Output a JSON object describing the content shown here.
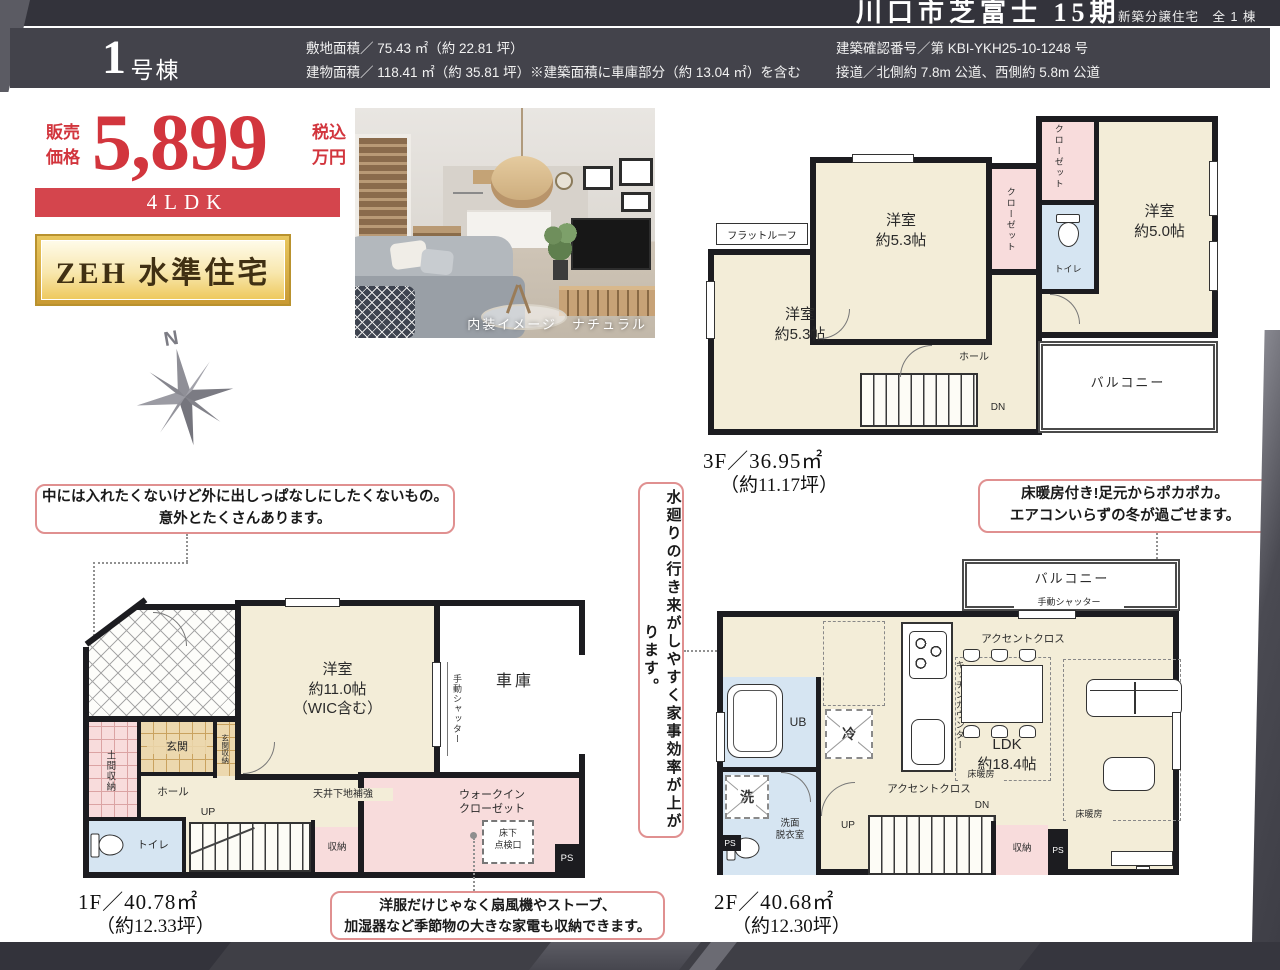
{
  "top_bar": {
    "title": "川口市芝富士 15期",
    "subtitle": "新築分譲住宅　全 1 棟"
  },
  "header": {
    "unit_number": "1",
    "unit_suffix": "号棟",
    "site_area": "敷地面積／ 75.43 ㎡（約 22.81 坪）",
    "building_area": "建物面積／ 118.41 ㎡（約 35.81 坪）※建築面積に車庫部分（約 13.04 ㎡）を含む",
    "confirmation_number": "建築確認番号／第 KBI-YKH25-10-1248 号",
    "road_access": "接道／北側約 7.8m 公道、西側約 5.8m 公道"
  },
  "price": {
    "label": "販売\n価格",
    "amount": "5,899",
    "tax_note": "税込\n万円",
    "floor_plan_type": "4LDK"
  },
  "zeh_badge": "ZEH 水準住宅",
  "compass_north": "N",
  "photo_caption": "内装イメージ　ナチュラル",
  "plan_3f": {
    "floor_area": "3F／36.95㎡",
    "floor_area_tsubo": "（約11.17坪）",
    "flat_roof": "フラットルーフ",
    "bedroom_53": "洋室\n約5.3帖",
    "bedroom_50": "洋室\n約5.0帖",
    "closet": "クローゼット",
    "toilet": "トイレ",
    "hall": "ホール",
    "down": "DN",
    "balcony": "バルコニー"
  },
  "plan_1f": {
    "floor_area": "1F／40.78㎡",
    "floor_area_tsubo": "（約12.33坪）",
    "doma_storage": "土間収納",
    "entrance": "玄関",
    "entrance_storage": "玄関収納",
    "hall": "ホール",
    "up": "UP",
    "toilet": "トイレ",
    "storage": "収納",
    "bedroom_110": "洋室\n約11.0帖\n（WIC含む）",
    "manual_shutter": "手動シャッター",
    "garage": "車庫",
    "walk_in_closet": "ウォークイン\nクローゼット",
    "ceiling_reinforce": "天井下地補強",
    "floor_hatch": "床下\n点検口",
    "ps": "PS"
  },
  "plan_2f": {
    "floor_area": "2F／40.68㎡",
    "floor_area_tsubo": "（約12.30坪）",
    "balcony": "バルコニー",
    "manual_shutter": "手動シャッター",
    "accent_cloth": "アクセントクロス",
    "kitchen_counter": "キッチンカウンター",
    "ldk": "LDK\n約18.4帖",
    "floor_heating": "床暖房",
    "ub": "UB",
    "fridge": "冷",
    "washer": "洗",
    "washroom": "洗面\n脱衣室",
    "ps": "PS",
    "up": "UP",
    "down": "DN",
    "storage": "収納"
  },
  "callouts": {
    "outdoor_storage": "中には入れたくないけど外に出しっぱなしにしたくないもの。\n意外とたくさんあります。",
    "water_flow": "水廻りの行き来がしやすく家事効率が上がります。",
    "floor_heating": "床暖房付き!足元からポカポカ。\nエアコンいらずの冬が過ごせます。",
    "wic_storage": "洋服だけじゃなく扇風機やストーブ、\n加湿器など季節物の大きな家電も収納できます。"
  }
}
